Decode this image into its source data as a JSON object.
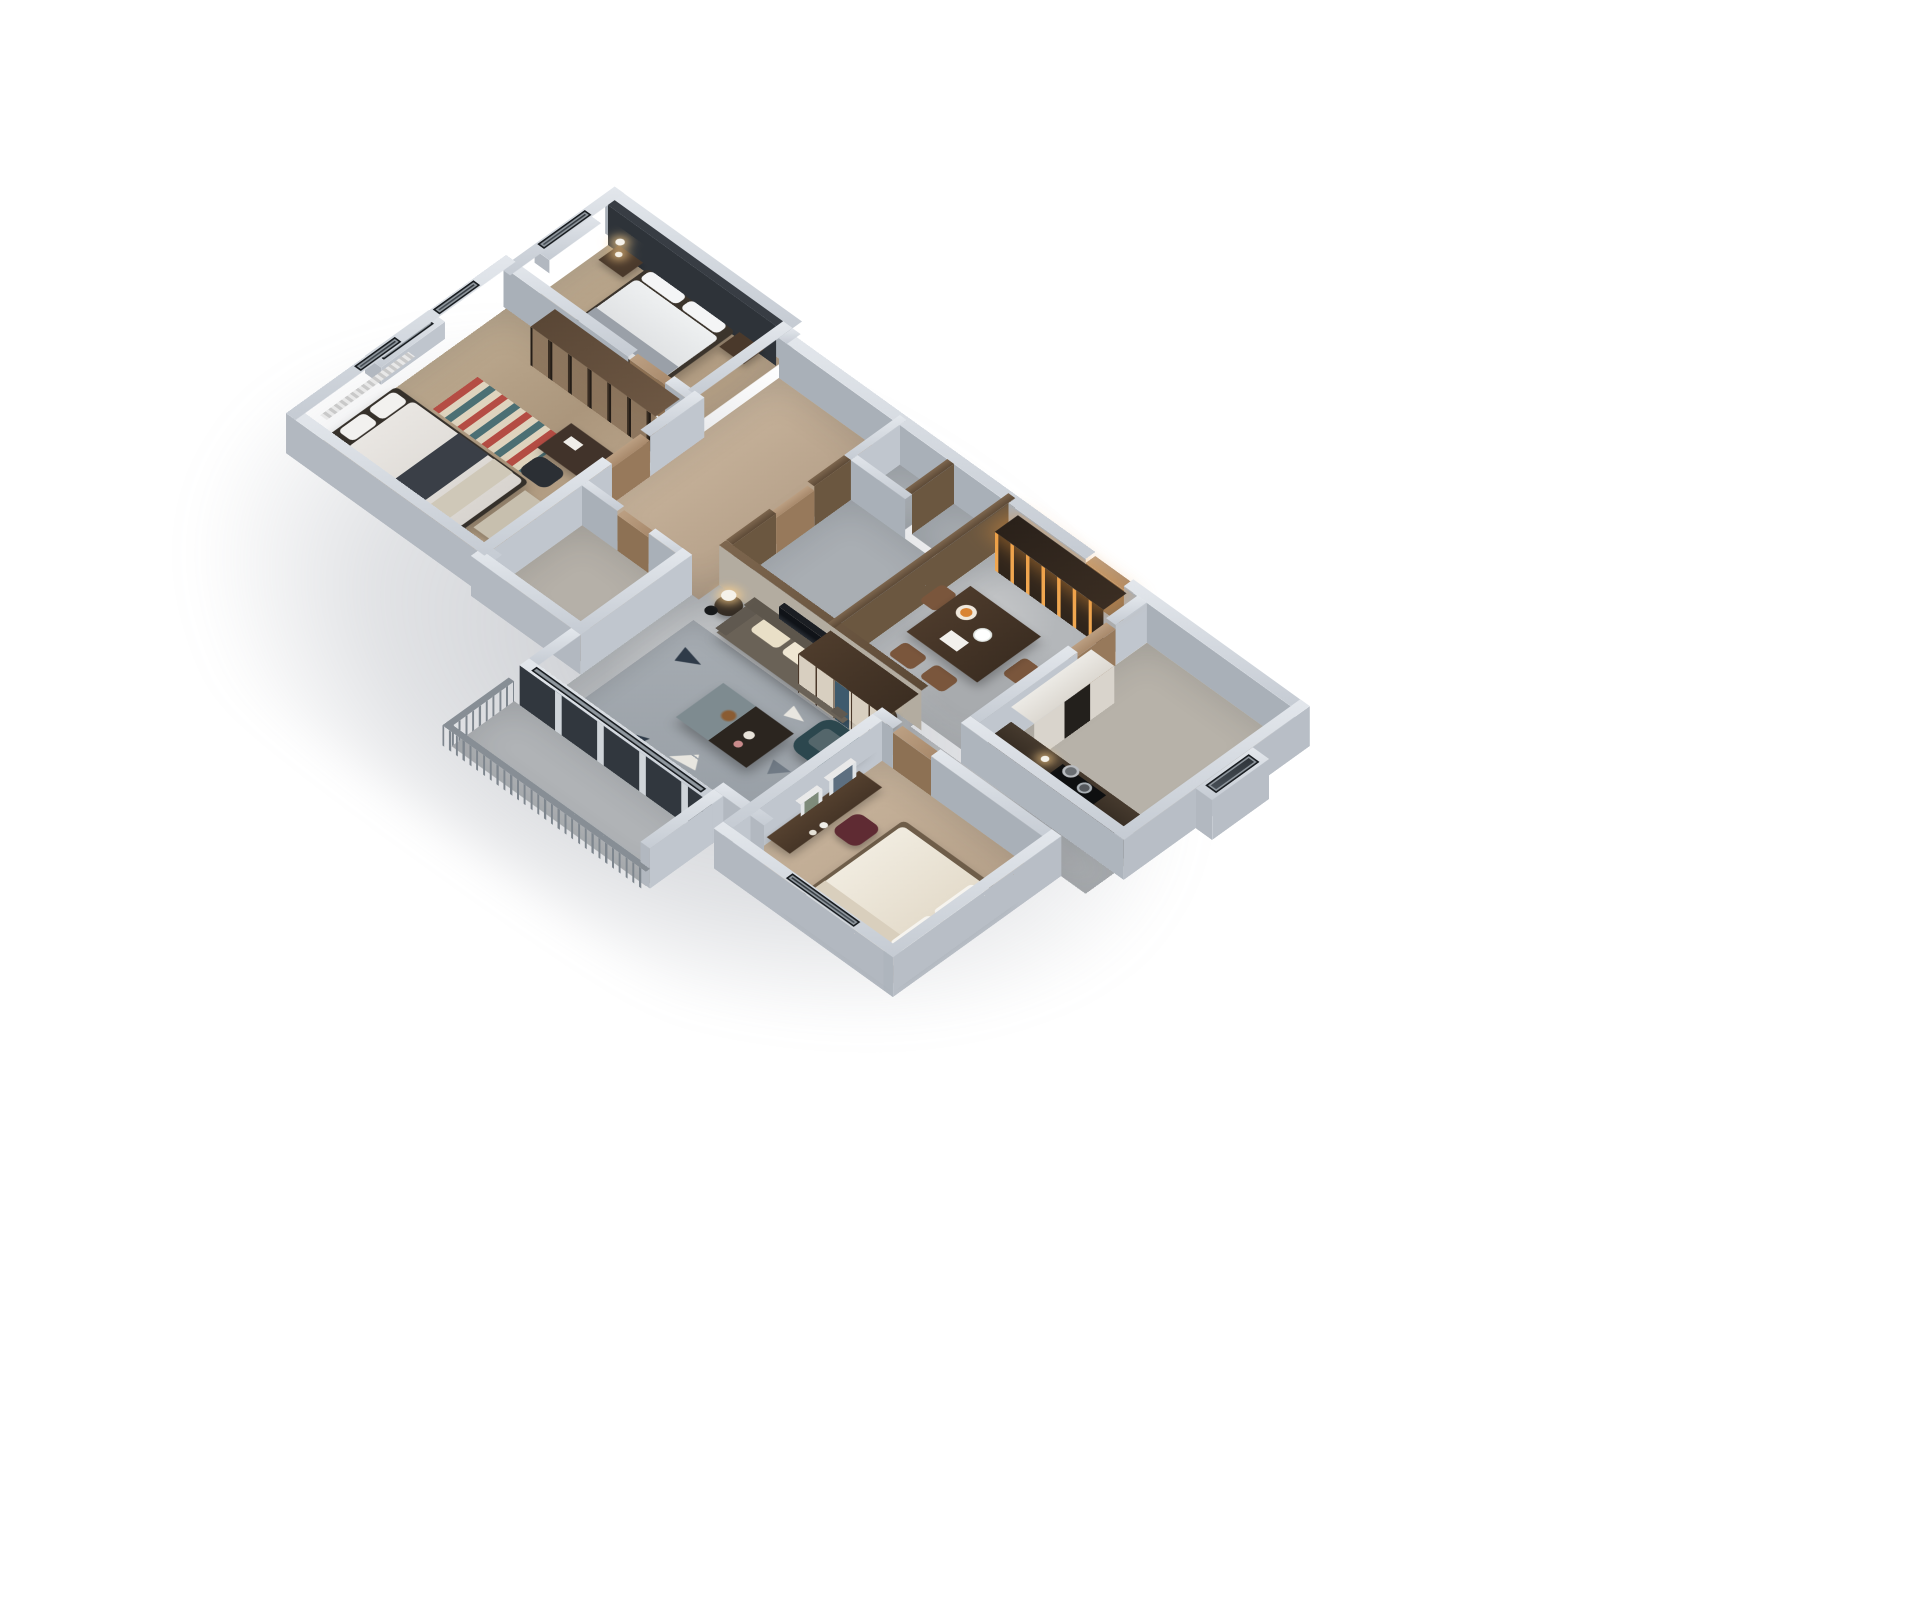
{
  "scene": {
    "type": "3d-isometric-floorplan-render",
    "background": "#ffffff",
    "description": "Bird's-eye axonometric cutaway render of a furnished three-bedroom apartment on a white background",
    "palette": {
      "wall_top": "#d9dee3",
      "wall_face": "#b2b8c0",
      "wood_floor": "#b69f87",
      "concrete_floor": "#b4b7ba",
      "dark_wood": "#4a382a",
      "cream": "#e8e0cb",
      "teal_armchair": "#2c474e",
      "amber_glow": "#e09a4e",
      "duvet_white": "#eaebec",
      "maroon_chair": "#5f2b33",
      "door_tan": "#b2957a"
    },
    "rooms": [
      {
        "name": "guest-bedroom",
        "items": [
          "double-bed",
          "white-duvet",
          "nightstands",
          "pendant-lamps",
          "charcoal-accent-wall",
          "window"
        ]
      },
      {
        "name": "master-suite",
        "items": [
          "glass-door-wardrobe",
          "writing-desk",
          "office-chair",
          "chevron-rug",
          "double-bed",
          "bench",
          "curtains",
          "windows",
          "bay-ledge"
        ]
      },
      {
        "name": "entry-corridor",
        "items": [
          "front-door",
          "wood-floor"
        ]
      },
      {
        "name": "utility-shaft",
        "items": []
      },
      {
        "name": "main-bathroom",
        "items": [
          "wood-paneled-walls",
          "door"
        ]
      },
      {
        "name": "master-bathroom",
        "items": [
          "door"
        ]
      },
      {
        "name": "dining-room",
        "items": [
          "dining-table",
          "leather-chairs",
          "fruit-plate",
          "flowers",
          "papers",
          "backlit-wine-cabinet",
          "kitchen-door"
        ]
      },
      {
        "name": "kitchen",
        "items": [
          "dark-counter",
          "cooktop",
          "pots",
          "tall-oven-unit",
          "window-bay"
        ]
      },
      {
        "name": "living-room",
        "items": [
          "leather-sofa",
          "cream-cushions",
          "leaning-artwork",
          "floor-lamp",
          "round-side-tables",
          "table-lamps",
          "coffee-table",
          "teal-armchair",
          "geometric-rug",
          "storage-cabinet"
        ]
      },
      {
        "name": "bedroom-three",
        "items": [
          "bed",
          "vanity-desk",
          "wall-frames",
          "maroon-chair",
          "decor-jars",
          "window"
        ]
      },
      {
        "name": "balcony",
        "items": [
          "slat-railing",
          "sliding-glass-doors",
          "curtain",
          "teal-throw"
        ]
      }
    ]
  }
}
